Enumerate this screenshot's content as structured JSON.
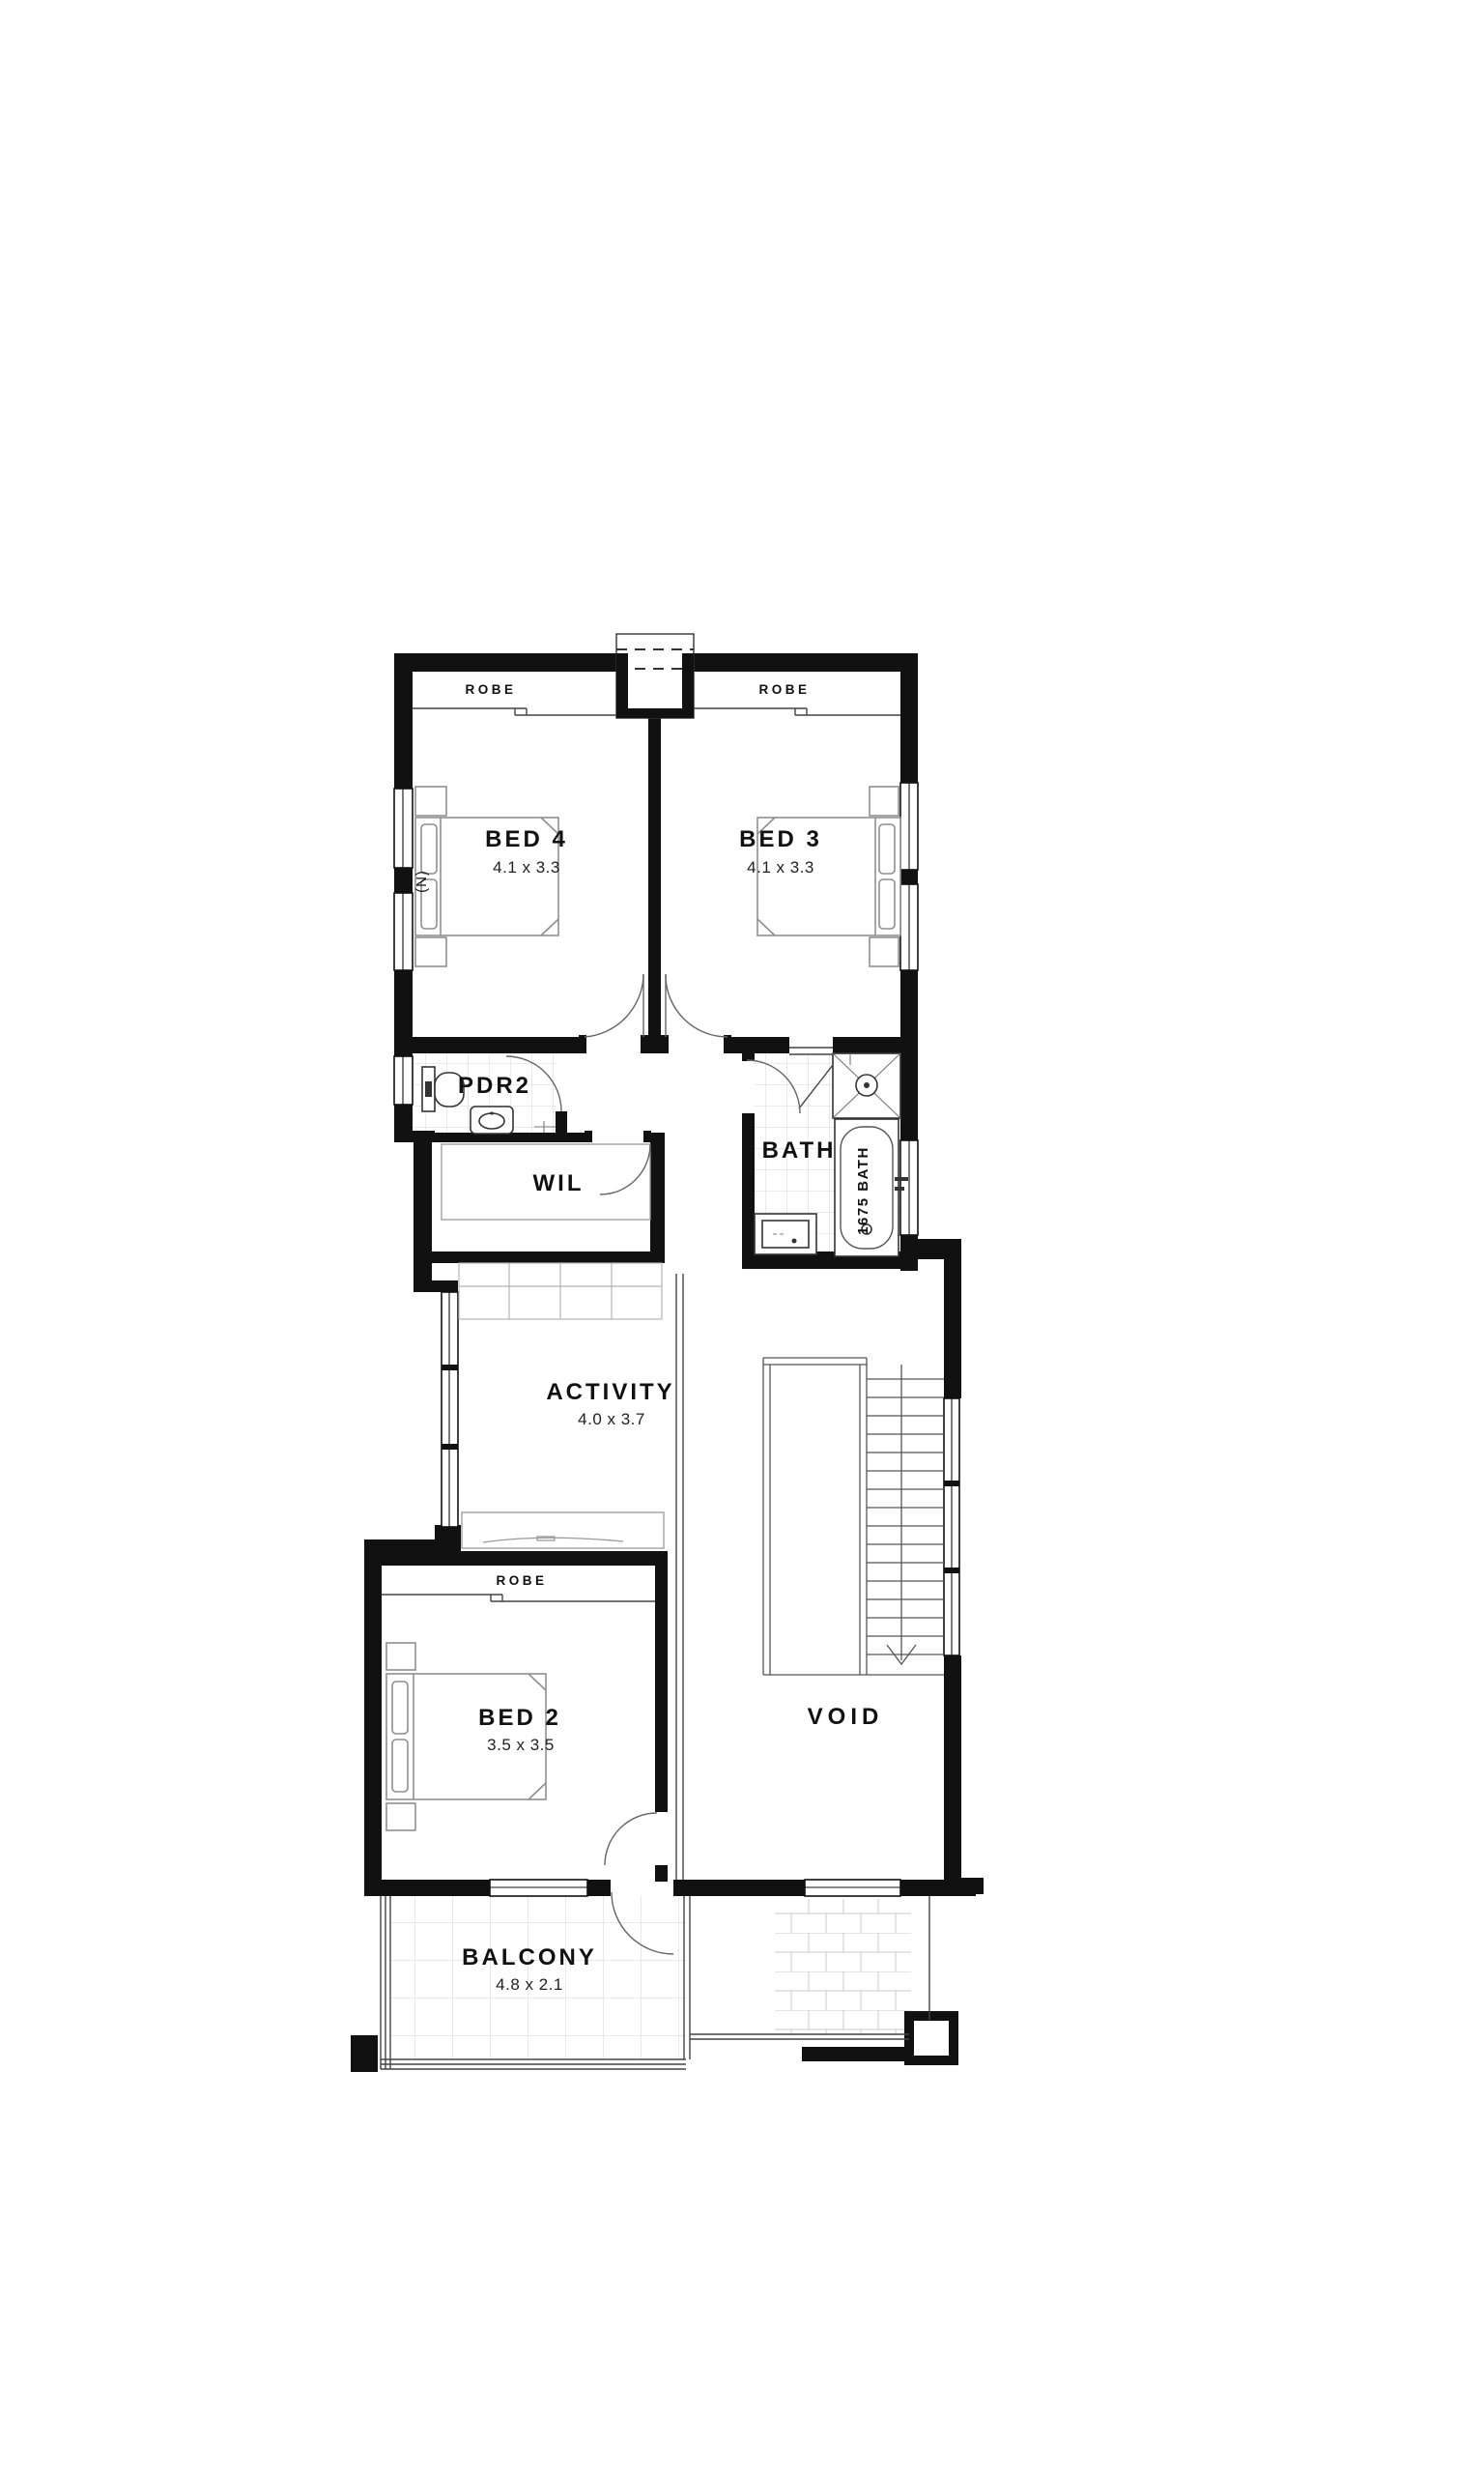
{
  "floor_plan": {
    "rooms": {
      "bed4": {
        "name": "BED 4",
        "dimensions": "4.1 x 3.3"
      },
      "bed3": {
        "name": "BED 3",
        "dimensions": "4.1 x 3.3"
      },
      "bed2": {
        "name": "BED 2",
        "dimensions": "3.5 x 3.5"
      },
      "activity": {
        "name": "ACTIVITY",
        "dimensions": "4.0 x 3.7"
      },
      "balcony": {
        "name": "BALCONY",
        "dimensions": "4.8 x 2.1"
      },
      "pdr2": {
        "name": "PDR2"
      },
      "wil": {
        "name": "WIL"
      },
      "bath": {
        "name": "BATH"
      },
      "void": {
        "name": "VOID"
      }
    },
    "labels": {
      "robe": "ROBE",
      "tub": "1675 BATH",
      "north": "(N)"
    },
    "colors": {
      "wall": "#111111",
      "text": "#111111",
      "furniture_line": "#8f8f8f",
      "tile_line": "#d6d6d6",
      "background": "#ffffff"
    }
  }
}
